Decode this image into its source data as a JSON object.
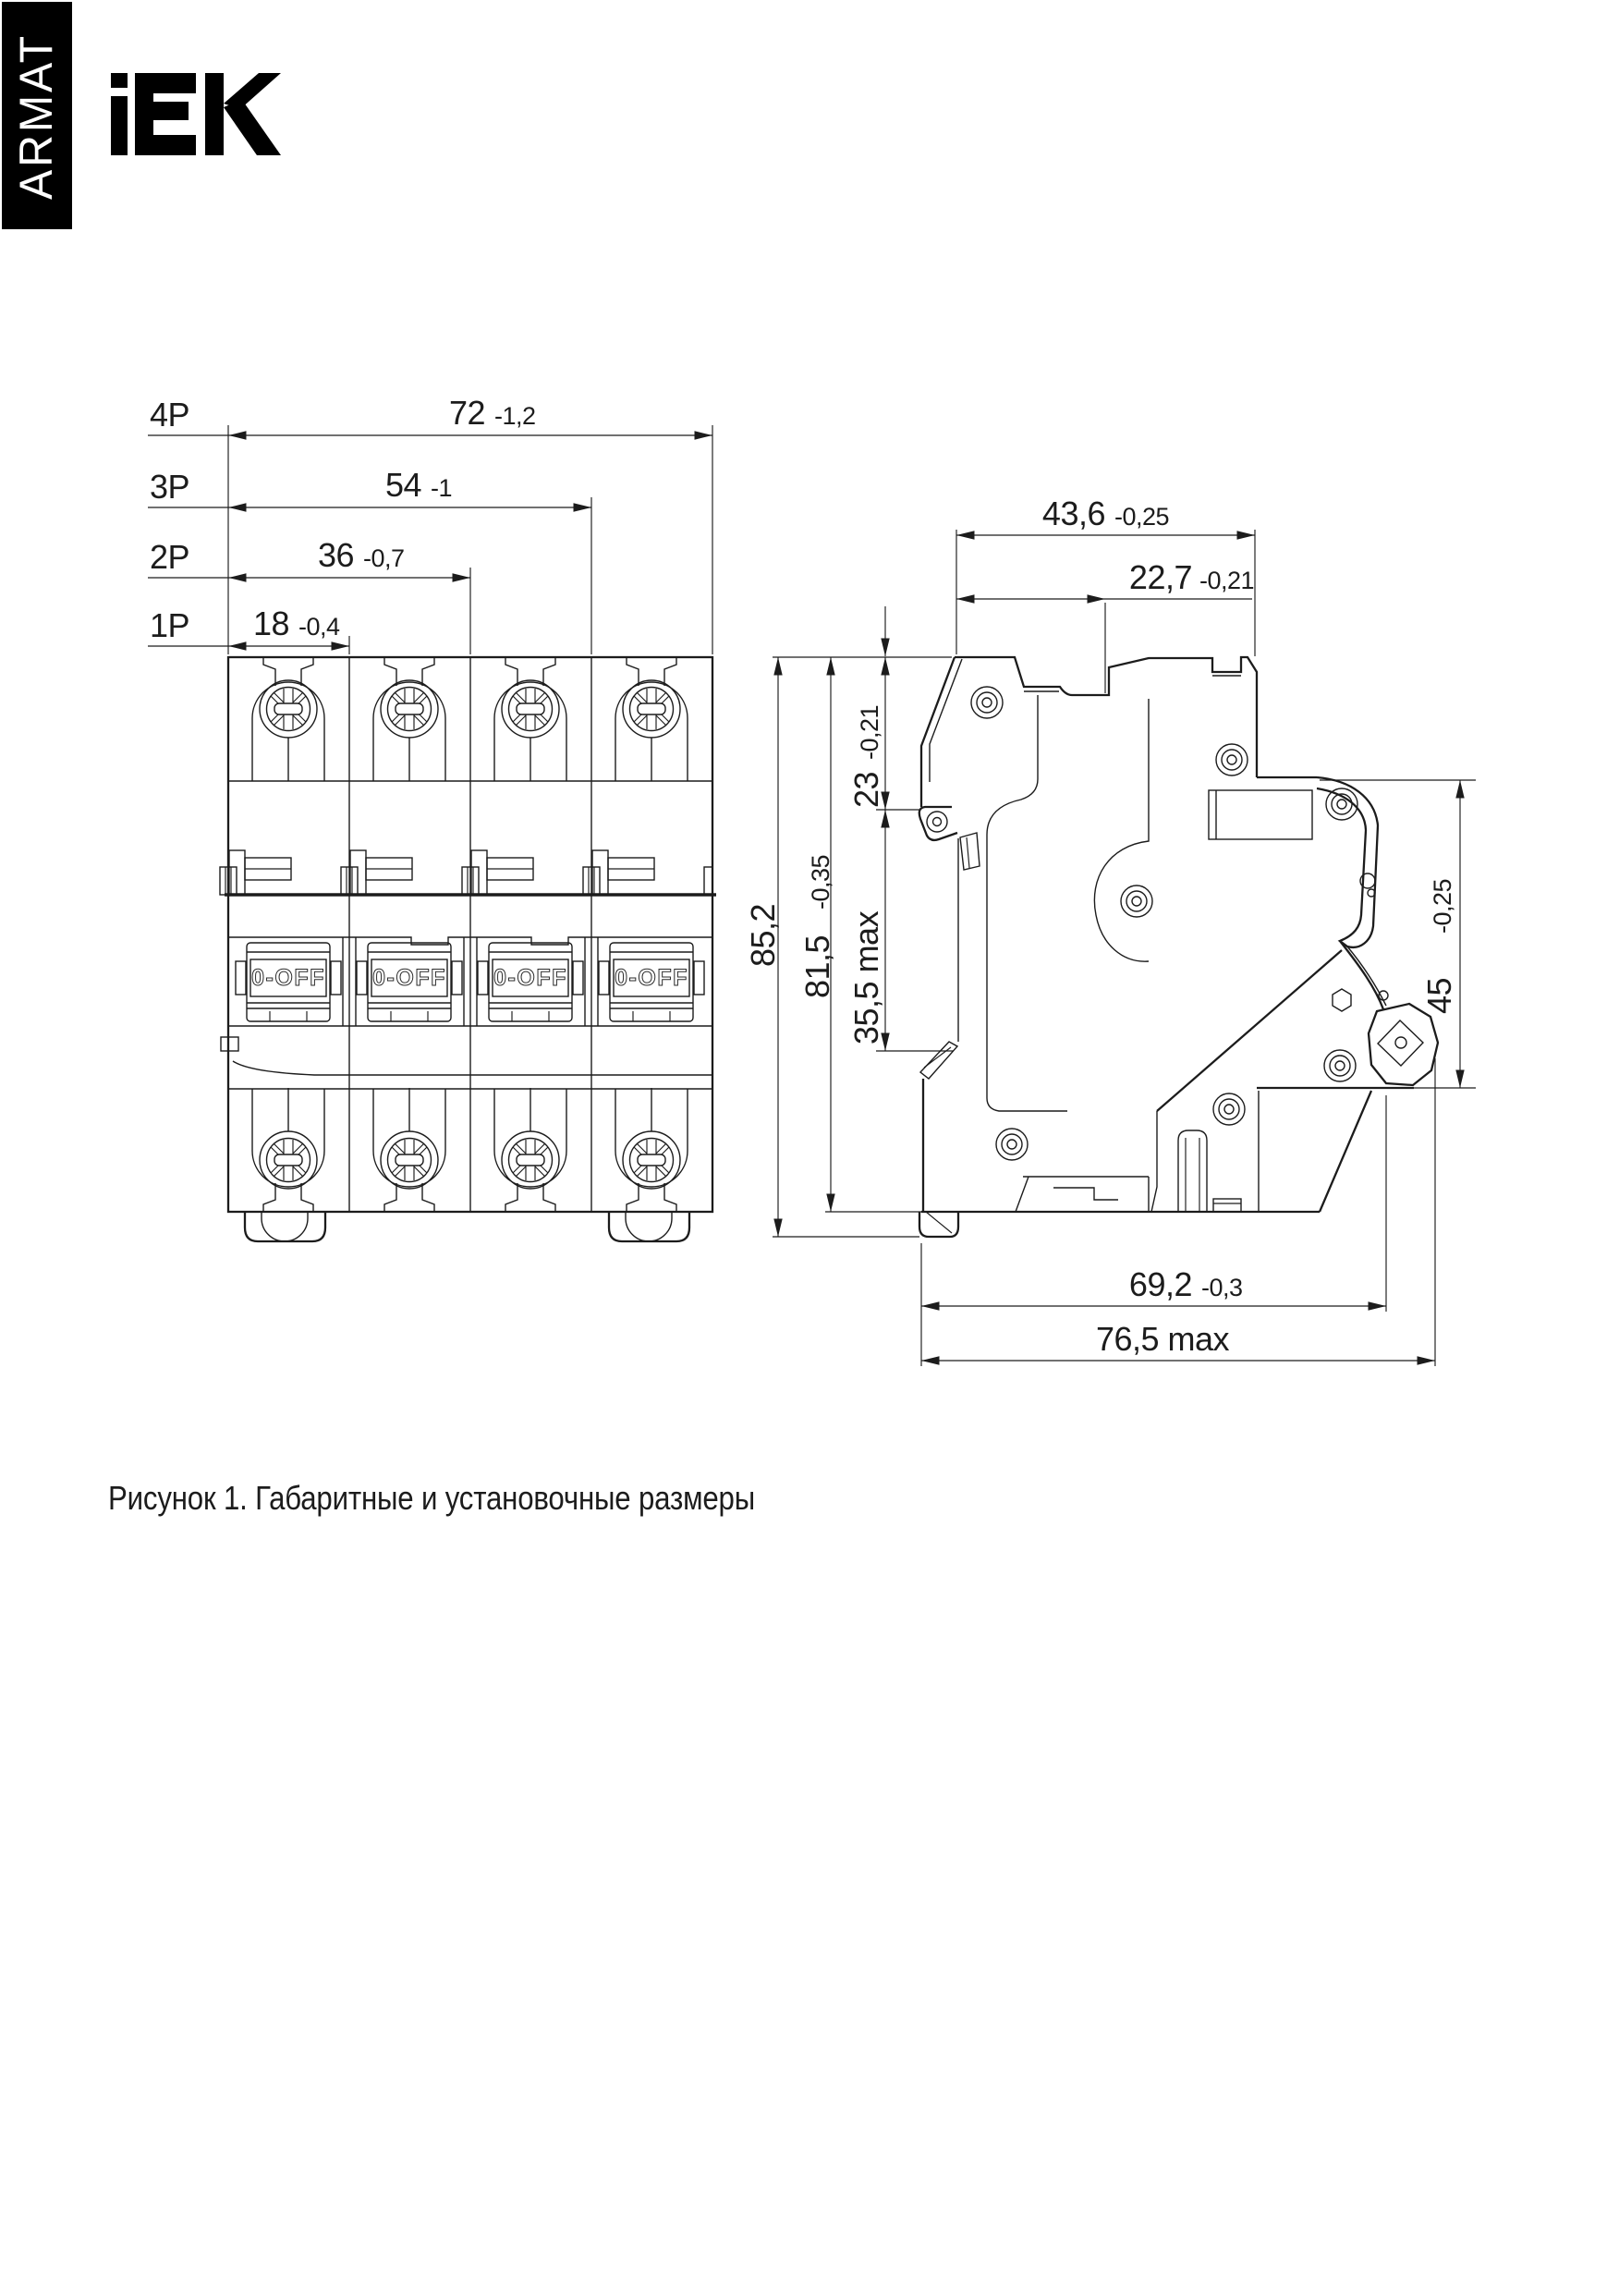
{
  "brand": {
    "banner": "ARMAT",
    "logo": "IEK"
  },
  "front_view": {
    "pole_dims": [
      {
        "label": "4P",
        "value": "72",
        "tolerance": "-1,2"
      },
      {
        "label": "3P",
        "value": "54",
        "tolerance": "-1"
      },
      {
        "label": "2P",
        "value": "36",
        "tolerance": "-0,7"
      },
      {
        "label": "1P",
        "value": "18",
        "tolerance": "-0,4"
      }
    ],
    "toggle_label": "0-OFF"
  },
  "side_view": {
    "dims": {
      "overall_width": {
        "value": "43,6",
        "tolerance": "-0,25"
      },
      "rail_offset_width": {
        "value": "22,7",
        "tolerance": "-0,21"
      },
      "overall_height": {
        "value": "85,2",
        "tolerance": ""
      },
      "body_height": {
        "value": "81,5",
        "tolerance": "-0,35"
      },
      "top_to_rail": {
        "value": "23",
        "tolerance": "-0,21"
      },
      "rail_zone_height": {
        "value": "35,5 max",
        "tolerance": ""
      },
      "terminal_zone_height": {
        "value": "45",
        "tolerance": "-0,25"
      },
      "depth_to_terminal": {
        "value": "69,2",
        "tolerance": "-0,3"
      },
      "max_depth": {
        "value": "76,5 max",
        "tolerance": ""
      }
    }
  },
  "caption": "Рисунок 1. Габаритные и установочные размеры",
  "colors": {
    "ink": "#1c1c1c",
    "paper": "#ffffff",
    "banner": "#000000"
  }
}
